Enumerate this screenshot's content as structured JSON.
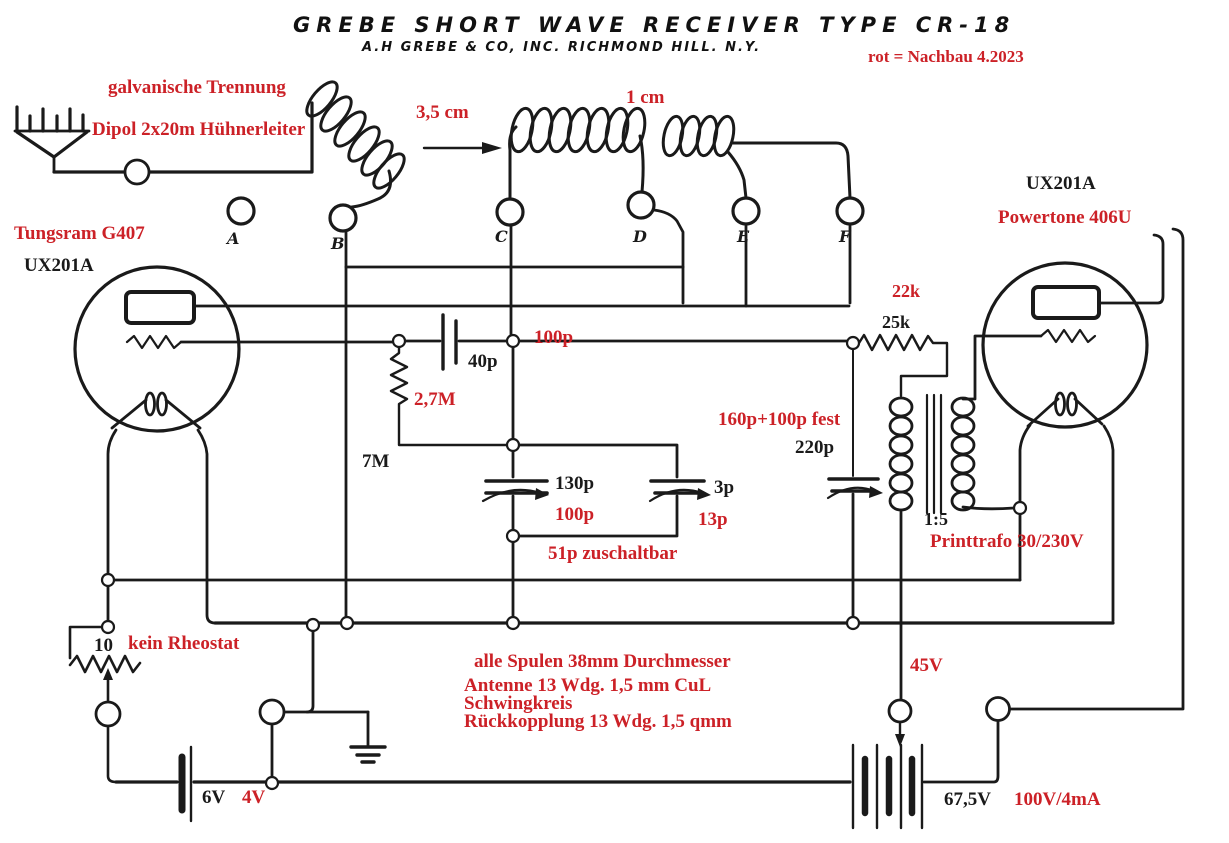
{
  "colors": {
    "red": "#cc2127",
    "ink": "#1a1a1a",
    "bg": "#ffffff"
  },
  "header": {
    "title": "GREBE  SHORT  WAVE  RECEIVER  TYPE CR-18",
    "subtitle": "A.H GREBE & CO, INC.   RICHMOND HILL. N.Y.",
    "note_red": "rot = Nachbau 4.2023"
  },
  "antenna": {
    "line1": "galvanische Trennung",
    "line2": "Dipol 2x20m Hühnerleiter",
    "spacing": "3,5 cm",
    "coil_gap": "1 cm"
  },
  "terminals": [
    "A",
    "B",
    "C",
    "D",
    "E",
    "F"
  ],
  "tube_left": {
    "name_red": "Tungsram G407",
    "type_black": "UX201A"
  },
  "tube_right": {
    "type_black": "UX201A",
    "name_red": "Powertone 406U"
  },
  "parts": {
    "grid_cap_black": "40p",
    "grid_cap_red": "100p",
    "grid_leak_red": "2,7M",
    "grid_leak_black": "7M",
    "tuning_cap_black": "130p",
    "tuning_cap_red": "100p",
    "trim_cap_black": "3p",
    "trim_cap_red": "13p",
    "switchable_red": "51p zuschaltbar",
    "coupling_res_red": "22k",
    "coupling_res_black": "25k",
    "bypass_red": "160p+100p fest",
    "bypass_black": "220p",
    "trafo_ratio": "1:5",
    "trafo_red": "Printtrafo 30/230V",
    "rheostat_black": "10",
    "rheostat_red": "kein Rheostat"
  },
  "coil_notes": {
    "line1": "alle Spulen 38mm Durchmesser",
    "line2": "Antenne 13 Wdg. 1,5 mm CuL",
    "line3": "Schwingkreis",
    "line4": "Rückkopplung 13 Wdg. 1,5 qmm"
  },
  "power": {
    "tap_red": "45V",
    "fil_black": "6V",
    "fil_red": "4V",
    "plate_black": "67,5V",
    "plate_red": "100V/4mA"
  }
}
